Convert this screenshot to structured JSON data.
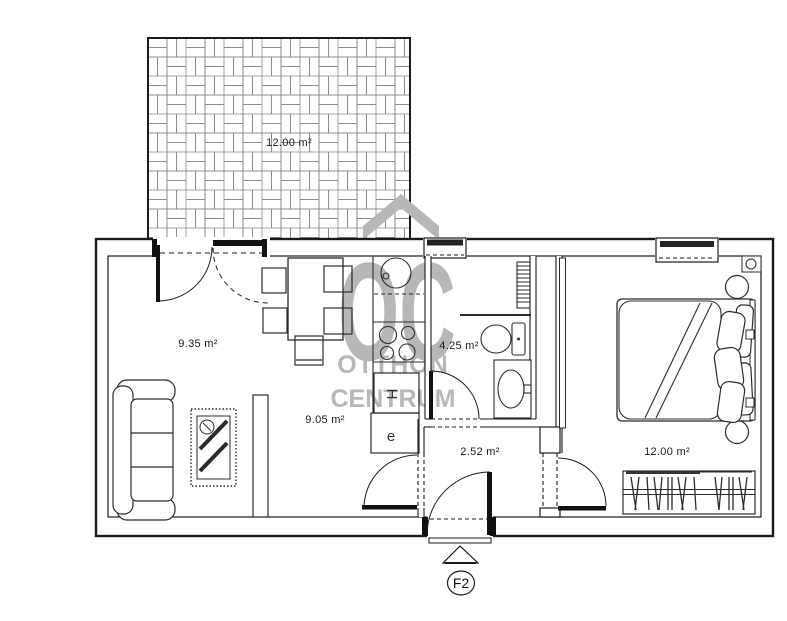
{
  "plan": {
    "marker": {
      "entrance_label": "F2"
    },
    "watermark": {
      "logo": "OC",
      "line1": "OTTHON",
      "line2": "CENTRUM"
    },
    "rooms": {
      "terrace": {
        "area": "12.00 m²"
      },
      "living": {
        "area": "9.35 m²"
      },
      "kitchen": {
        "area": "9.05 m²"
      },
      "bathroom": {
        "area": "4.25 m²"
      },
      "hall": {
        "area": "2.52 m²"
      },
      "bedroom": {
        "area": "12.00 m²"
      }
    },
    "labels": {
      "fridge": "H",
      "appliance": "e"
    },
    "colors": {
      "line": "#1a1a1a",
      "watermark": "#b7b7b7",
      "background": "#ffffff"
    }
  }
}
